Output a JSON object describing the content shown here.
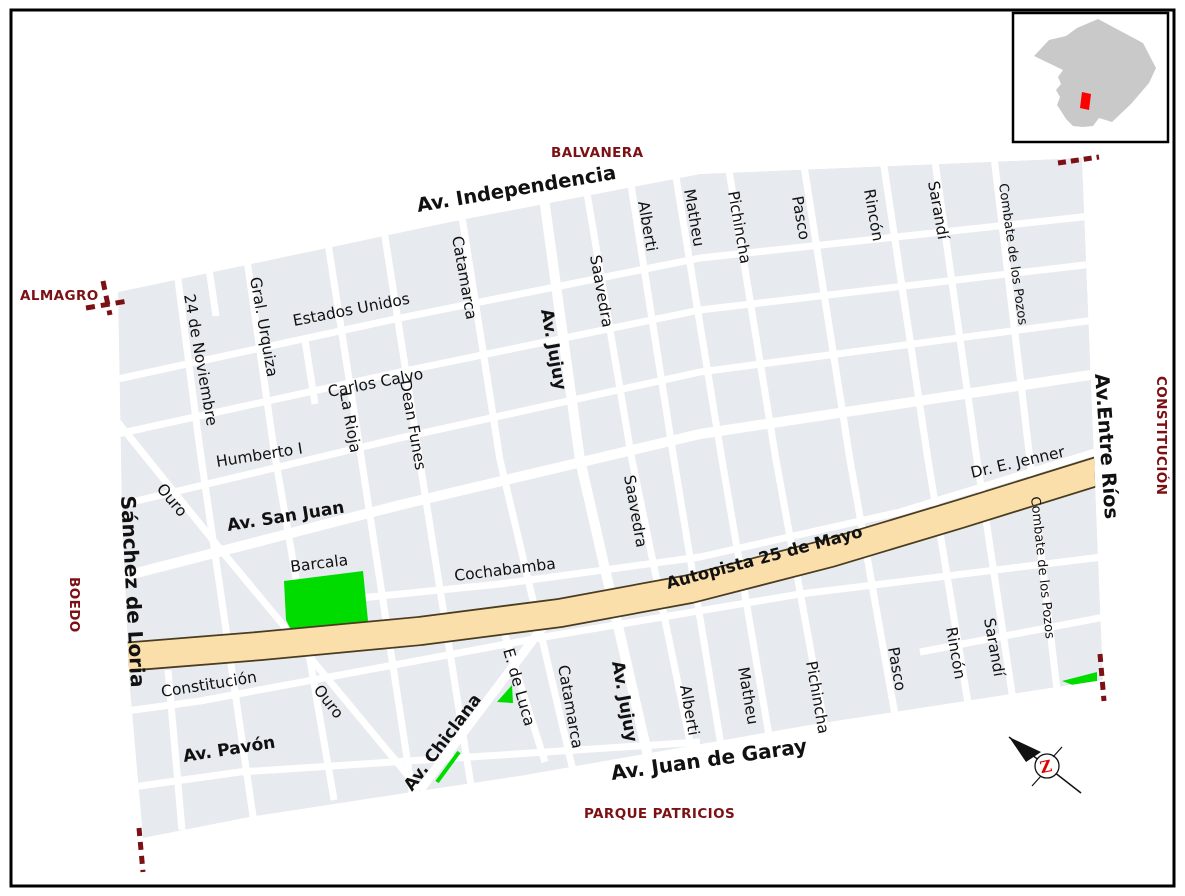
{
  "neighborhoods": {
    "balvanera": "BALVANERA",
    "almagro": "ALMAGRO",
    "boedo": "BOEDO",
    "constitucion": "CONSTITUCIÓN",
    "parque_patricios": "PARQUE PATRICIOS"
  },
  "streets": {
    "independencia": "Av. Independencia",
    "estados_unidos": "Estados Unidos",
    "carlos_calvo": "Carlos Calvo",
    "humberto_i": "Humberto I",
    "san_juan": "Av. San Juan",
    "barcala": "Barcala",
    "cochabamba": "Cochabamba",
    "constitucion": "Constitución",
    "pavon": "Av. Pavón",
    "juan_de_garay": "Av. Juan de Garay",
    "jenner": "Dr. E. Jenner",
    "sanchez_de_loria": "Sánchez de Loria",
    "nov24": "24 de Noviembre",
    "urquiza": "Gral. Urquiza",
    "la_rioja": "La Rioja",
    "dean_funes": "Dean Funes",
    "catamarca": "Catamarca",
    "jujuy": "Av. Jujuy",
    "saavedra": "Saavedra",
    "alberti": "Alberti",
    "matheu": "Matheu",
    "pichincha": "Pichincha",
    "pasco": "Pasco",
    "rincon": "Rincón",
    "sarandi": "Sarandí",
    "combate": "Combate de los Pozos",
    "entre_rios": "Av.Entre Ríos",
    "ouro": "Ouro",
    "chiclana": "Av. Chiclana",
    "de_luca": "E. de Luca"
  },
  "highway": {
    "label": "Autopista 25 de Mayo"
  },
  "compass": {
    "letter": "Z"
  },
  "colors": {
    "block": "#e7eaee",
    "street": "#ffffff",
    "highway_fill": "#fbdfab",
    "highway_edge": "#4a3c20",
    "park": "#00dc00",
    "boundary": "#7b1114",
    "inset_city": "#c9c9c9",
    "inset_marker": "#ff0000",
    "border": "#000000"
  }
}
